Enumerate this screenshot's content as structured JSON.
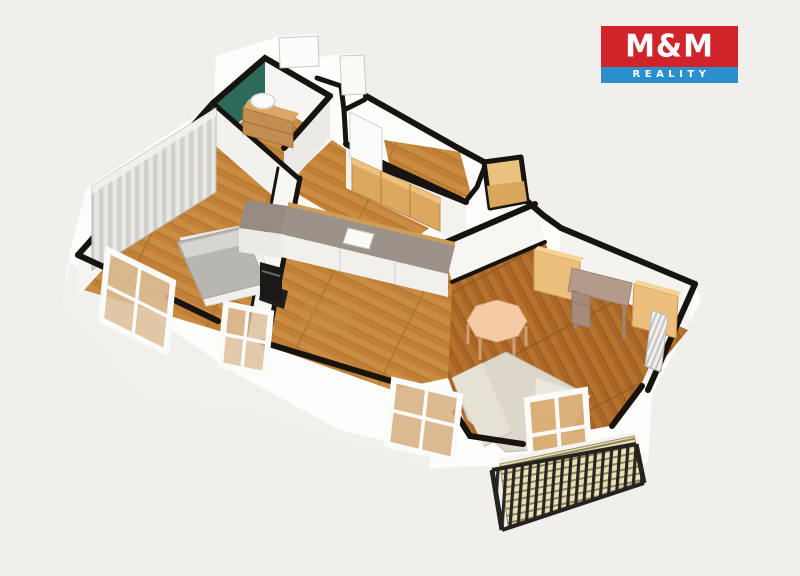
{
  "page": {
    "background_color": "#f0efeb",
    "content": "3D isometric cutaway floor plan of an apartment"
  },
  "logo": {
    "company": "M&M Reality",
    "line1": "M&M",
    "line2": "REALITY",
    "colors": {
      "top_bg": "#d0242a",
      "bottom_bg": "#2b8ecd",
      "text": "#ffffff"
    }
  },
  "floor_plan": {
    "view": "isometric 3D cutaway, walls cut with black top edges",
    "wall_cut_color": "#17130f",
    "wall_face_color": "#fcfcfa",
    "rooms": [
      {
        "name": "bathroom",
        "accent_wall_color": "#2e6a5c",
        "floor": "light wood",
        "furniture": [
          "wood vanity cabinet",
          "white washbasin"
        ]
      },
      {
        "name": "bedroom",
        "floor": "light wood",
        "furniture": [
          "striped wardrobe",
          "double bed with grey mattress"
        ],
        "windows": 2
      },
      {
        "name": "hallway-entry",
        "floor": "light wood",
        "furniture": [
          "wood entrance door"
        ]
      },
      {
        "name": "kitchen",
        "floor": "light wood",
        "furniture": [
          "L-shaped counter",
          "grey countertop",
          "sink",
          "black oven",
          "wood upper cabinets"
        ],
        "windows": 1
      },
      {
        "name": "living-room",
        "floor": "dark wood",
        "furniture": [
          "octagonal dining table",
          "cream corner sofa",
          "desk",
          "two wood cabinets",
          "radiator"
        ],
        "windows": 1,
        "doors": [
          "balcony door"
        ]
      },
      {
        "name": "balcony",
        "floor": "wood slats",
        "furniture": [
          "black metal railing"
        ]
      }
    ],
    "palette": {
      "floor_light_wood": "#ca8c42",
      "floor_dark_wood": "#b5712e",
      "cabinet_wood": "#dca75e",
      "counter_top_grey": "#9d9289",
      "sofa_cream": "#dcd7c9",
      "table_peach": "#f4cba5",
      "mattress_grey": "#b8b6b1",
      "teal_wall": "#2e6a5c",
      "railing_black": "#26231f",
      "balcony_floor": "#eadfbb",
      "window_glass": "#ddc09a"
    }
  }
}
